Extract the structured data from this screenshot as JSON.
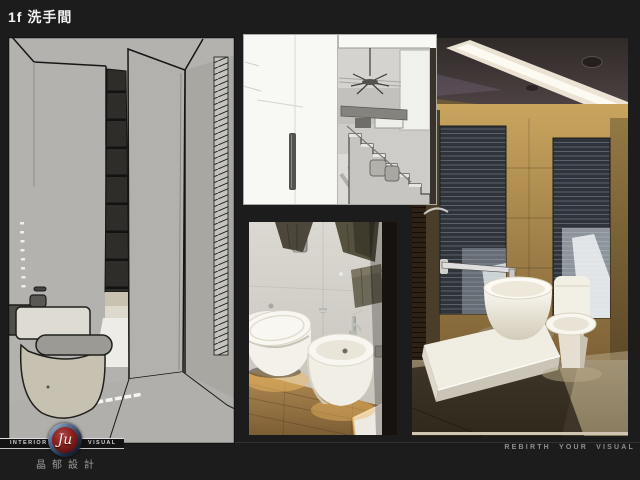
{
  "slide": {
    "title": "1f 洗手間"
  },
  "footer": {
    "brand": {
      "left_label": "INTERIOR",
      "right_label": "VISUAL",
      "monogram": "Ju",
      "chinese_name": "晶郁設計"
    },
    "tagline": "REBIRTH YOUR VISUAL"
  },
  "colors": {
    "background": "#1c1c1c",
    "logo_ring_blue": "#3c5474",
    "logo_red": "#7a1818",
    "text_gray": "#9a9a9a",
    "sketch_gray": "#b3b2ae",
    "photo_warm_tan": "#c9a55e"
  }
}
